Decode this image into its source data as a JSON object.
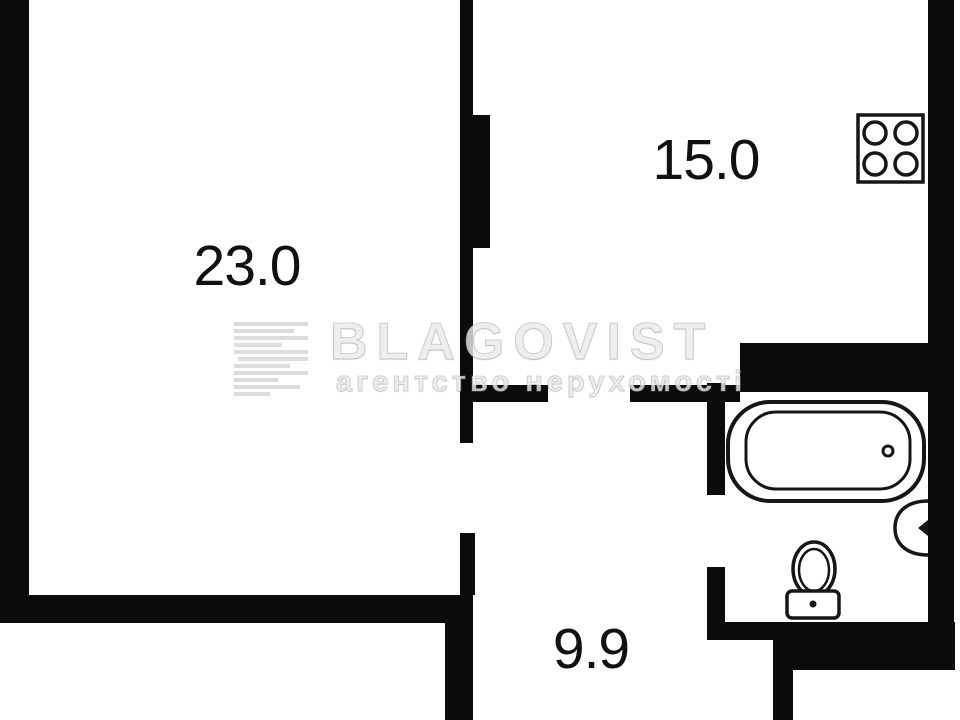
{
  "floorplan": {
    "rooms": [
      {
        "name": "living-room",
        "area": "23.0"
      },
      {
        "name": "kitchen",
        "area": "15.0"
      },
      {
        "name": "hallway",
        "area": "9.9"
      }
    ],
    "fixtures": [
      "stove-icon",
      "bathtub-icon",
      "sink-icon",
      "toilet-icon"
    ],
    "watermark": {
      "brand": "BLAGOVIST",
      "tagline": "агентство нерухомості"
    },
    "colors": {
      "wall": "#0b0b0b",
      "background": "#ffffff",
      "fixture_stroke": "#161616",
      "watermark": "#ebebeb"
    }
  }
}
